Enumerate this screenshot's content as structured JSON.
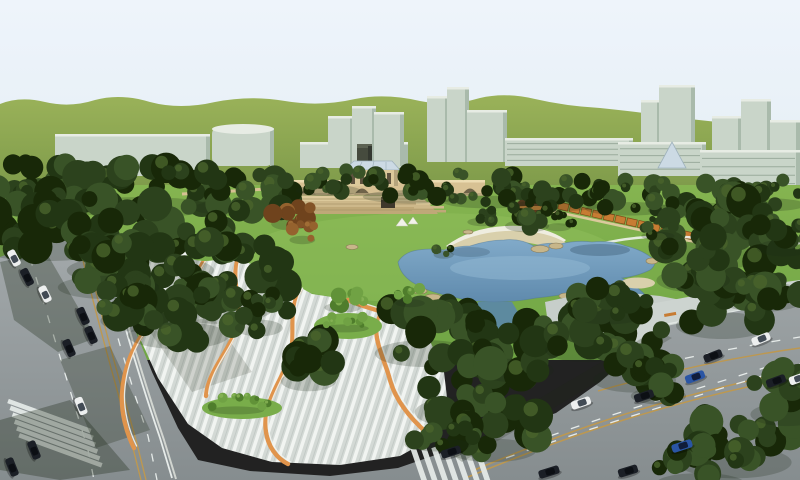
{
  "scene": {
    "kind": "3d-architectural-rendering",
    "subject": "urban-park-master-plan-aerial-view"
  },
  "palette": {
    "sky1": "#eef4fb",
    "sky2": "#e4eef4",
    "hill1": "#9ab259",
    "hill2": "#6d8c41",
    "bldFace": "#c9d5c9",
    "bldShade": "#a9baab",
    "bldTop": "#e7ece4",
    "bldWin": "#9aab9c",
    "towerDark": "#464b3e",
    "towerDarkTop": "#5c6252",
    "lawn1": "#85b450",
    "lawn2": "#6fa544",
    "lawnHi": "#92c15d",
    "mound": "#79ad4a",
    "treeD1": "#223614",
    "treeD2": "#2c421d",
    "treeD3": "#395327",
    "treeD4": "#182808",
    "treeDHi": "#4a642c",
    "treeB1": "#4f7d2c",
    "treeB2": "#619238",
    "treeB3": "#70a244",
    "treeBHi": "#8ab557",
    "treeR1": "#6f431d",
    "treeR2": "#835327",
    "treeR3": "#95622e",
    "treeRHi": "#a8743a",
    "bridge": "#d7c193",
    "bridgeTop": "#ecdcb2",
    "bridgeDark": "#6f6349",
    "bridgeShade": "#b5a47c",
    "terrace1": "#dcc99b",
    "terrace2": "#cdb88a",
    "terrace3": "#bfa878",
    "glassRoof": "#ccdae4",
    "glassFrame": "#9fb2bc",
    "pavRoof": "#5d3b1e",
    "pavGlow": "#c2803a",
    "pavBase": "#8a5a2e",
    "pergola": "#c77c33",
    "pergolaDark": "#7c4a18",
    "pergBase": "#dbc99c",
    "pathWhite": "#f0f3ef",
    "pond1": "#81aac9",
    "pond2": "#5b86a9",
    "pondEdge": "#4d7595",
    "pondHi": "#93b9d4",
    "pondDark": "#3c5a72",
    "sand": "#d9d0ac",
    "sandLight": "#efede0",
    "rock": "#c7b68a",
    "rockEdge": "#8a7b56",
    "plazaBase": "#d3d9d5",
    "plazaLine": "#f1f4f1",
    "plazaFlat": "#c7ceca",
    "sidewalk": "#cdd4d0",
    "ribbon": "#e0944c",
    "road1": "#a3a9ab",
    "road2": "#868d8f",
    "laneWhite": "#e6ebe9",
    "laneTan": "#bd9850",
    "carDark": "#1b1f26",
    "carWhite": "#edefef",
    "carBlue": "#2a55a4",
    "carGlass": "#0c0f14",
    "carGlassW": "#424b55",
    "carGlassB": "#101c3a",
    "shadow": "#1c2715"
  },
  "buildings": [
    {
      "x": 55,
      "y": 134,
      "w": 155,
      "h": 42,
      "kind": "slab",
      "windows": false
    },
    {
      "x": 212,
      "y": 126,
      "w": 62,
      "h": 40,
      "kind": "cyl",
      "windows": false
    },
    {
      "x": 300,
      "y": 142,
      "w": 108,
      "h": 26,
      "kind": "slab",
      "windows": false
    },
    {
      "x": 328,
      "y": 116,
      "w": 26,
      "h": 50,
      "kind": "tower",
      "windows": false
    },
    {
      "x": 352,
      "y": 106,
      "w": 24,
      "h": 60,
      "kind": "tower",
      "windows": false
    },
    {
      "x": 374,
      "y": 112,
      "w": 30,
      "h": 54,
      "kind": "tower",
      "windows": false
    },
    {
      "x": 427,
      "y": 96,
      "w": 22,
      "h": 66,
      "kind": "tower",
      "windows": false
    },
    {
      "x": 447,
      "y": 87,
      "w": 22,
      "h": 75,
      "kind": "tower",
      "windows": false
    },
    {
      "x": 467,
      "y": 110,
      "w": 40,
      "h": 52,
      "kind": "slab",
      "windows": false
    },
    {
      "x": 505,
      "y": 138,
      "w": 128,
      "h": 28,
      "kind": "slab",
      "windows": true
    },
    {
      "x": 641,
      "y": 100,
      "w": 20,
      "h": 74,
      "kind": "tower",
      "windows": false
    },
    {
      "x": 659,
      "y": 85,
      "w": 36,
      "h": 89,
      "kind": "tower",
      "windows": false
    },
    {
      "x": 618,
      "y": 142,
      "w": 88,
      "h": 34,
      "kind": "slab",
      "windows": true
    },
    {
      "x": 712,
      "y": 116,
      "w": 30,
      "h": 76,
      "kind": "tower",
      "windows": false
    },
    {
      "x": 741,
      "y": 99,
      "w": 30,
      "h": 93,
      "kind": "tower",
      "windows": false
    },
    {
      "x": 770,
      "y": 120,
      "w": 30,
      "h": 72,
      "kind": "tower",
      "windows": false
    },
    {
      "x": 700,
      "y": 150,
      "w": 100,
      "h": 42,
      "kind": "slab",
      "windows": true
    }
  ],
  "treeClusters": [
    [
      40,
      182,
      70,
      20,
      24,
      "dark"
    ],
    [
      150,
      188,
      85,
      24,
      30,
      "dark"
    ],
    [
      255,
      192,
      60,
      20,
      20,
      "dark"
    ],
    [
      332,
      180,
      35,
      13,
      12,
      "dark"
    ],
    [
      420,
      184,
      55,
      16,
      18,
      "dark"
    ],
    [
      495,
      190,
      50,
      15,
      16,
      "dark"
    ],
    [
      565,
      194,
      48,
      14,
      14,
      "dark"
    ],
    [
      635,
      196,
      48,
      16,
      16,
      "dark"
    ],
    [
      705,
      196,
      55,
      18,
      18,
      "dark"
    ],
    [
      770,
      192,
      45,
      16,
      14,
      "dark"
    ],
    [
      55,
      222,
      75,
      32,
      26,
      "dark"
    ],
    [
      150,
      240,
      80,
      38,
      28,
      "dark"
    ],
    [
      225,
      275,
      62,
      40,
      24,
      "dark"
    ],
    [
      185,
      310,
      55,
      32,
      20,
      "dark"
    ],
    [
      115,
      265,
      55,
      28,
      20,
      "dark"
    ],
    [
      142,
      300,
      40,
      26,
      14,
      "dark"
    ],
    [
      262,
      312,
      26,
      20,
      10,
      "dark"
    ],
    [
      312,
      362,
      30,
      24,
      12,
      "dark"
    ],
    [
      432,
      328,
      55,
      32,
      22,
      "dark"
    ],
    [
      472,
      382,
      55,
      38,
      22,
      "dark"
    ],
    [
      520,
      348,
      42,
      28,
      16,
      "dark"
    ],
    [
      498,
      428,
      48,
      28,
      16,
      "dark"
    ],
    [
      442,
      432,
      36,
      16,
      10,
      "dark"
    ],
    [
      592,
      328,
      45,
      28,
      16,
      "dark"
    ],
    [
      640,
      356,
      45,
      30,
      16,
      "dark"
    ],
    [
      612,
      300,
      38,
      20,
      12,
      "dark"
    ],
    [
      662,
      380,
      30,
      20,
      10,
      "dark"
    ],
    [
      718,
      228,
      62,
      34,
      22,
      "dark"
    ],
    [
      768,
      268,
      50,
      36,
      20,
      "dark"
    ],
    [
      728,
      300,
      50,
      32,
      18,
      "dark"
    ],
    [
      698,
      258,
      40,
      28,
      14,
      "dark"
    ],
    [
      788,
      232,
      30,
      20,
      10,
      "dark"
    ],
    [
      742,
      432,
      62,
      38,
      20,
      "dark"
    ],
    [
      792,
      392,
      40,
      28,
      14,
      "dark"
    ],
    [
      706,
      464,
      48,
      24,
      14,
      "dark"
    ],
    [
      345,
      298,
      20,
      12,
      7,
      "bright"
    ],
    [
      412,
      296,
      16,
      9,
      6,
      "bright"
    ],
    [
      292,
      212,
      20,
      15,
      8,
      "red"
    ],
    [
      304,
      232,
      14,
      10,
      6,
      "red"
    ],
    [
      530,
      214,
      24,
      15,
      10,
      "dark"
    ],
    [
      484,
      214,
      16,
      10,
      6,
      "dark"
    ],
    [
      560,
      220,
      14,
      9,
      5,
      "dark"
    ],
    [
      348,
      322,
      26,
      8,
      8,
      "bright"
    ],
    [
      240,
      404,
      30,
      8,
      9,
      "bright"
    ],
    [
      445,
      250,
      11,
      6,
      4,
      "dark"
    ],
    [
      660,
      228,
      18,
      10,
      6,
      "dark"
    ]
  ],
  "pergola": {
    "x1": 552,
    "y1": 204,
    "x2": 700,
    "y2": 238,
    "count": 14,
    "w": 10,
    "h": 7
  },
  "rocks": [
    [
      420,
      291,
      7,
      3
    ],
    [
      433,
      297,
      8,
      3
    ],
    [
      447,
      297,
      6,
      2.5
    ],
    [
      540,
      249,
      9,
      3.5
    ],
    [
      556,
      246,
      7,
      3
    ],
    [
      652,
      261,
      6,
      3
    ],
    [
      566,
      296,
      7,
      3
    ],
    [
      610,
      291,
      6,
      2.5
    ],
    [
      757,
      296,
      7,
      3
    ],
    [
      700,
      250,
      6,
      2.5
    ],
    [
      352,
      247,
      6,
      2.5
    ],
    [
      468,
      232,
      5,
      2
    ]
  ],
  "ribbons": [
    "M208,252 C196,282 172,300 152,322 C136,340 124,364 122,394 C121,412 126,432 134,448",
    "M238,258 C230,284 244,306 236,330 C228,352 208,372 206,396",
    "M300,290 C286,314 298,338 288,362 C278,386 262,406 266,432 C268,446 276,458 288,464",
    "M382,312 C368,334 384,356 390,380 C396,402 412,420 428,434",
    "M348,300 C360,306 372,308 382,312"
  ],
  "crosswalks": [
    {
      "x": 8,
      "y": 401,
      "barAngle": 20,
      "advAngle": 72,
      "len": 88,
      "w": 4.6,
      "gap": 2.6,
      "count": 6
    },
    {
      "x": 412,
      "y": 445,
      "barAngle": 71,
      "advAngle": 6,
      "len": 40,
      "w": 5.5,
      "gap": 5.5,
      "count": 7
    }
  ],
  "cars": [
    {
      "x": 14,
      "y": 258,
      "rot": 62,
      "color": "White",
      "len": 17
    },
    {
      "x": 27,
      "y": 277,
      "rot": 63,
      "color": "Dark",
      "len": 18
    },
    {
      "x": 45,
      "y": 294,
      "rot": 64,
      "color": "White",
      "len": 17
    },
    {
      "x": 83,
      "y": 316,
      "rot": 66,
      "color": "Dark",
      "len": 18
    },
    {
      "x": 91,
      "y": 335,
      "rot": 66,
      "color": "Dark",
      "len": 18
    },
    {
      "x": 69,
      "y": 348,
      "rot": 66,
      "color": "Dark",
      "len": 18
    },
    {
      "x": 81,
      "y": 406,
      "rot": 68,
      "color": "White",
      "len": 18
    },
    {
      "x": 34,
      "y": 450,
      "rot": 68,
      "color": "Dark",
      "len": 19
    },
    {
      "x": 12,
      "y": 467,
      "rot": 68,
      "color": "Dark",
      "len": 19
    },
    {
      "x": 451,
      "y": 452,
      "rot": -18,
      "color": "Dark",
      "len": 20
    },
    {
      "x": 549,
      "y": 472,
      "rot": -17,
      "color": "Dark",
      "len": 21
    },
    {
      "x": 581,
      "y": 403,
      "rot": -19,
      "color": "White",
      "len": 20
    },
    {
      "x": 644,
      "y": 396,
      "rot": -19,
      "color": "Dark",
      "len": 20
    },
    {
      "x": 695,
      "y": 377,
      "rot": -20,
      "color": "Blue",
      "len": 20
    },
    {
      "x": 713,
      "y": 356,
      "rot": -21,
      "color": "Dark",
      "len": 19
    },
    {
      "x": 761,
      "y": 339,
      "rot": -22,
      "color": "White",
      "len": 19
    },
    {
      "x": 776,
      "y": 381,
      "rot": -20,
      "color": "Dark",
      "len": 20
    },
    {
      "x": 682,
      "y": 446,
      "rot": -18,
      "color": "Blue",
      "len": 21
    },
    {
      "x": 628,
      "y": 471,
      "rot": -17,
      "color": "Dark",
      "len": 20
    },
    {
      "x": 797,
      "y": 379,
      "rot": -20,
      "color": "White",
      "len": 16
    }
  ]
}
